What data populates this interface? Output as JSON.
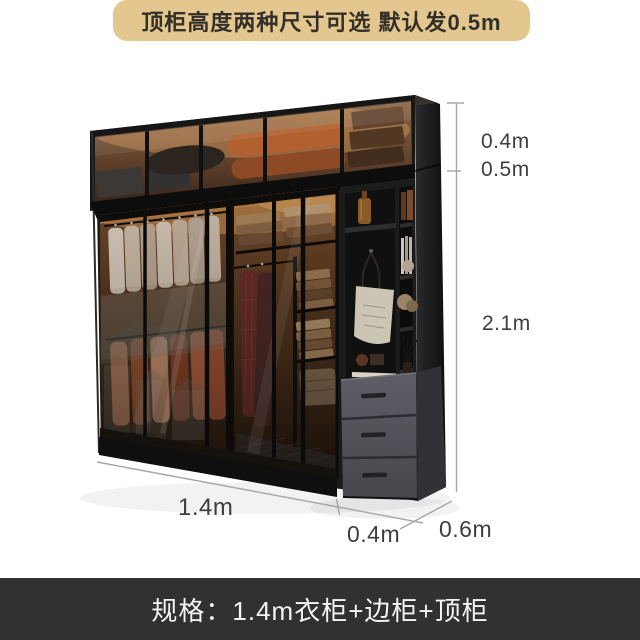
{
  "banner": {
    "text": "顶柜高度两种尺寸可选 默认发0.5m"
  },
  "spec_bar": {
    "text": "规格：1.4m衣柜+边柜+顶柜"
  },
  "dimension_labels": {
    "top_cabinet_option_a": "0.4m",
    "top_cabinet_option_b": "0.5m",
    "height": "2.1m",
    "main_width": "1.4m",
    "side_width": "0.4m",
    "depth": "0.6m"
  },
  "colors": {
    "banner_bg": "#e4c78f",
    "banner_text": "#33302a",
    "spec_bar_bg": "#323132",
    "spec_bar_text": "#f4f4f2",
    "dimension_text": "#3e3e3e",
    "dimension_line": "#a6a6a6",
    "cabinet_dark": "#1a1a1a",
    "drawer_gray": "#53535a",
    "glass_amber": "#6b4a31"
  }
}
